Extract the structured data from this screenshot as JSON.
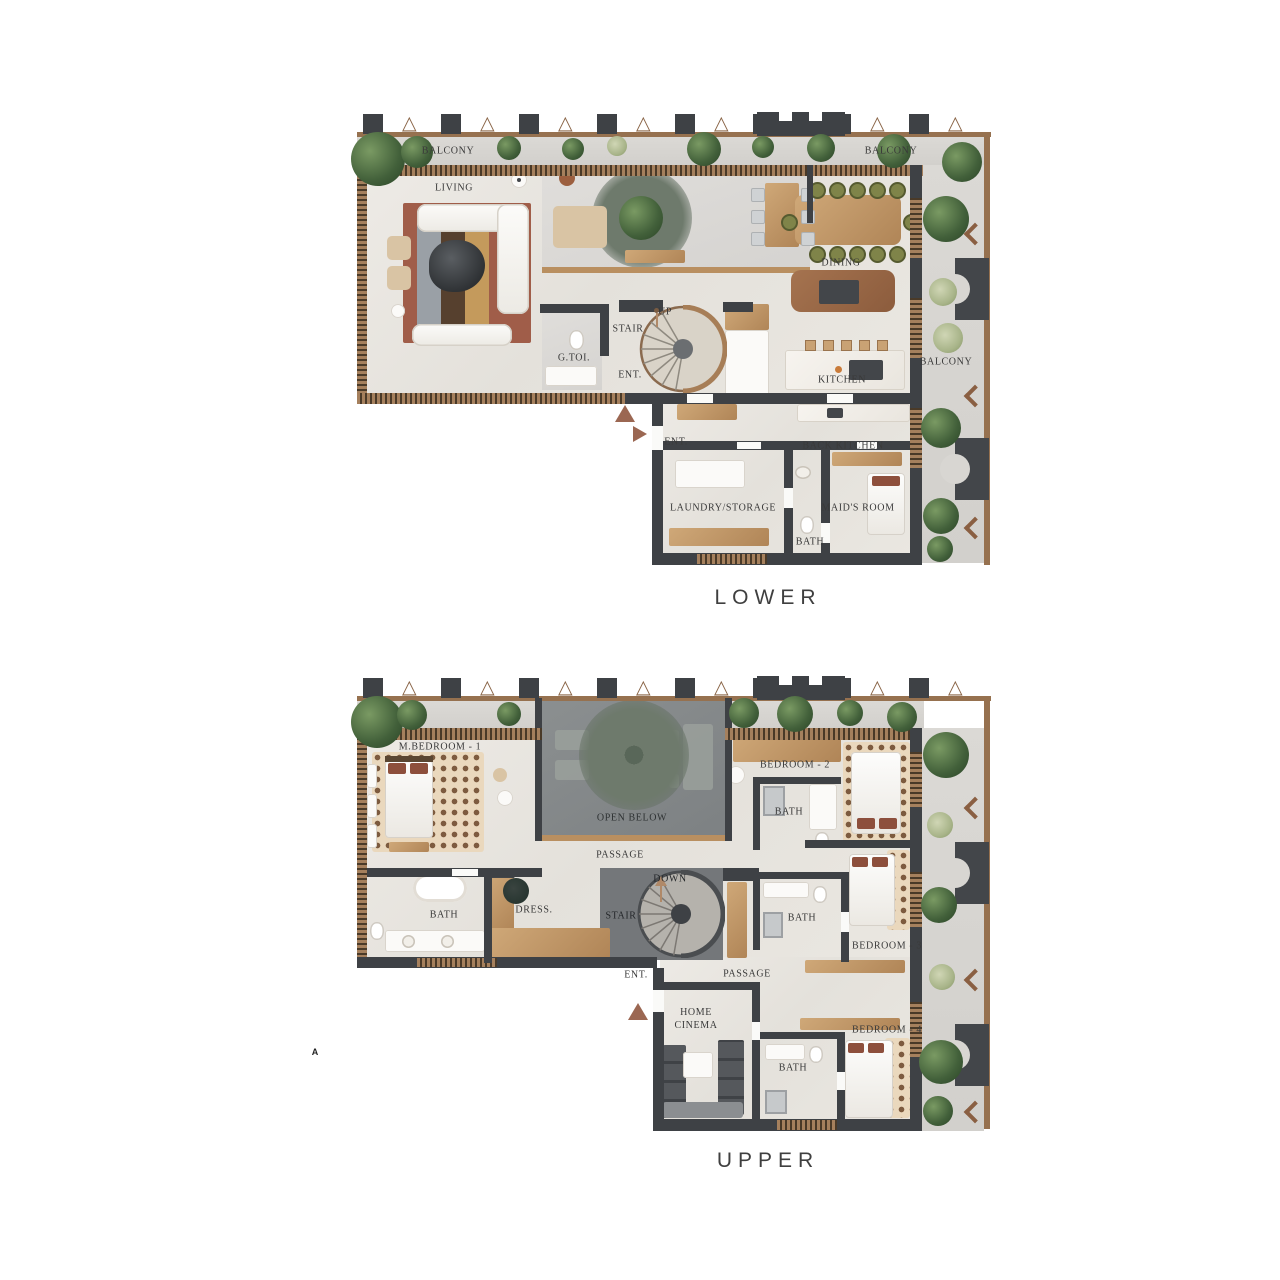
{
  "captions": {
    "lower": "LOWER",
    "upper": "UPPER"
  },
  "annotation": {
    "section_a": "A"
  },
  "lower": {
    "labels": {
      "balcony_nw": "BALCONY",
      "living": "LIVING",
      "balcony_ne": "BALCONY",
      "dining": "DINING",
      "up": "UP",
      "stair": "STAIR",
      "g_toi": "G.TOI.",
      "ent_stair": "ENT.",
      "kitchen": "KITCHEN",
      "balcony_e": "BALCONY",
      "ent_entry": "ENT.",
      "back_kitchen": "BACK KITCHEN",
      "laundry_storage": "LAUNDRY/STORAGE",
      "maids_room": "MAID'S ROOM",
      "bath": "BATH"
    }
  },
  "upper": {
    "labels": {
      "m_bedroom_1": "M.BEDROOM - 1",
      "bedroom_2": "BEDROOM - 2",
      "open_below": "OPEN BELOW",
      "bath_bedroom2": "BATH",
      "passage_upper": "PASSAGE",
      "down": "DOWN",
      "stair": "STAIR",
      "bath_master": "BATH",
      "dress": "DRESS.",
      "bath_bedroom3": "BATH",
      "bedroom_3": "BEDROOM - 3",
      "ent": "ENT.",
      "passage_lower": "PASSAGE",
      "home_cinema": "HOME CINEMA",
      "bedroom_4": "BEDROOM - 4",
      "bath_bedroom4": "BATH"
    }
  },
  "palette": {
    "wall": "#3e4145",
    "wood": "#c9a274",
    "floor": "#e8e5e0",
    "balcony_floor": "#d8d6d2",
    "courtyard": "#85898b",
    "plant_dark": "#42603a",
    "plant_sage": "#aeb98e",
    "rug_rust": "#9d5a46",
    "accent_brown": "#9b6752",
    "marble": "#f2efe9"
  }
}
